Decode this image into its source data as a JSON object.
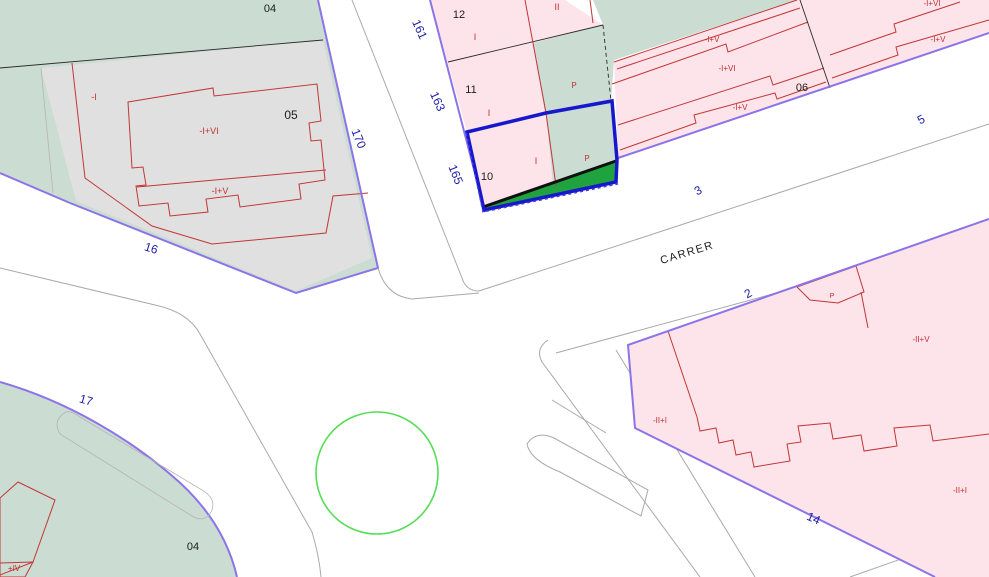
{
  "map": {
    "title": "cadastral-parcel-map",
    "street_name": "CARRER",
    "selected_parcel": {
      "number": "10",
      "zone_labels": [
        "I",
        "P"
      ]
    },
    "colors": {
      "building_fill": "#fce4ea",
      "courtyard_fill": "#cbdcd2",
      "unbuilt_fill": "#e0e0e0",
      "selection_outline": "#1717cc",
      "selection_area_fill": "#1fa33e",
      "parcel_border": "#8b74e8",
      "building_line": "#c23636",
      "street_number_text": "#1d1da8",
      "circle_stroke": "#55dd55"
    },
    "labels": [
      {
        "text": "04",
        "x": 270,
        "y": 12,
        "rot": 0,
        "cls": "lbl-black",
        "size": 11
      },
      {
        "text": "-I",
        "x": 94,
        "y": 100,
        "rot": 0,
        "cls": "lbl-red",
        "size": 9
      },
      {
        "text": "05",
        "x": 291,
        "y": 119,
        "rot": 0,
        "cls": "lbl-black",
        "size": 12
      },
      {
        "text": "-I+VI",
        "x": 209,
        "y": 134,
        "rot": 0,
        "cls": "lbl-red",
        "size": 9
      },
      {
        "text": "-I+V",
        "x": 220,
        "y": 194,
        "rot": 0,
        "cls": "lbl-red",
        "size": 9
      },
      {
        "text": "16",
        "x": 150,
        "y": 252,
        "rot": 18,
        "cls": "lbl-navy",
        "size": 12
      },
      {
        "text": "17",
        "x": 85,
        "y": 404,
        "rot": 16,
        "cls": "lbl-navy",
        "size": 12
      },
      {
        "text": "04",
        "x": 193,
        "y": 550,
        "rot": 0,
        "cls": "lbl-black",
        "size": 11
      },
      {
        "text": "+IV",
        "x": 14,
        "y": 571,
        "rot": 0,
        "cls": "lbl-red",
        "size": 8
      },
      {
        "text": "161",
        "x": 416,
        "y": 31,
        "rot": 66,
        "cls": "lbl-navy",
        "size": 12
      },
      {
        "text": "163",
        "x": 434,
        "y": 103,
        "rot": 66,
        "cls": "lbl-navy",
        "size": 12
      },
      {
        "text": "165",
        "x": 452,
        "y": 176,
        "rot": 68,
        "cls": "lbl-navy",
        "size": 12
      },
      {
        "text": "170",
        "x": 355,
        "y": 140,
        "rot": 68,
        "cls": "lbl-navy",
        "size": 12
      },
      {
        "text": "12",
        "x": 459,
        "y": 18,
        "rot": 0,
        "cls": "lbl-black",
        "size": 11
      },
      {
        "text": "I",
        "x": 475,
        "y": 40,
        "rot": 0,
        "cls": "lbl-red",
        "size": 9
      },
      {
        "text": "II",
        "x": 557,
        "y": 10,
        "rot": 0,
        "cls": "lbl-red",
        "size": 9
      },
      {
        "text": "11",
        "x": 471,
        "y": 93,
        "rot": 0,
        "cls": "lbl-black",
        "size": 11
      },
      {
        "text": "I",
        "x": 489,
        "y": 116,
        "rot": 0,
        "cls": "lbl-red",
        "size": 9
      },
      {
        "text": "P",
        "x": 574,
        "y": 88,
        "rot": 0,
        "cls": "lbl-red",
        "size": 8
      },
      {
        "text": "10",
        "x": 487,
        "y": 180,
        "rot": 0,
        "cls": "lbl-black",
        "size": 11
      },
      {
        "text": "I",
        "x": 536,
        "y": 164,
        "rot": 0,
        "cls": "lbl-red",
        "size": 9
      },
      {
        "text": "P",
        "x": 587,
        "y": 161,
        "rot": 0,
        "cls": "lbl-red",
        "size": 8
      },
      {
        "text": "-I+V",
        "x": 712,
        "y": 42,
        "rot": 0,
        "cls": "lbl-red",
        "size": 8
      },
      {
        "text": "-I+VI",
        "x": 727,
        "y": 71,
        "rot": 0,
        "cls": "lbl-red",
        "size": 8
      },
      {
        "text": "-I+V",
        "x": 740,
        "y": 110,
        "rot": 0,
        "cls": "lbl-red",
        "size": 8
      },
      {
        "text": "06",
        "x": 802,
        "y": 91,
        "rot": 0,
        "cls": "lbl-black",
        "size": 11
      },
      {
        "text": "-I+V",
        "x": 938,
        "y": 42,
        "rot": 0,
        "cls": "lbl-red",
        "size": 8
      },
      {
        "text": "-I+VI",
        "x": 932,
        "y": 6,
        "rot": 0,
        "cls": "lbl-red",
        "size": 8
      },
      {
        "text": "3",
        "x": 700,
        "y": 194,
        "rot": -28,
        "cls": "lbl-navy",
        "size": 12
      },
      {
        "text": "5",
        "x": 923,
        "y": 123,
        "rot": -28,
        "cls": "lbl-navy",
        "size": 12
      },
      {
        "text": "CARRER",
        "x": 688,
        "y": 256,
        "rot": -17,
        "cls": "lbl-street",
        "size": 11
      },
      {
        "text": "2",
        "x": 750,
        "y": 297,
        "rot": -28,
        "cls": "lbl-navy",
        "size": 12
      },
      {
        "text": "14",
        "x": 812,
        "y": 522,
        "rot": 24,
        "cls": "lbl-navy",
        "size": 12
      },
      {
        "text": "P",
        "x": 832,
        "y": 298,
        "rot": 0,
        "cls": "lbl-red",
        "size": 7
      },
      {
        "text": "-II+V",
        "x": 921,
        "y": 342,
        "rot": 0,
        "cls": "lbl-red",
        "size": 8
      },
      {
        "text": "-II+I",
        "x": 660,
        "y": 423,
        "rot": 0,
        "cls": "lbl-red",
        "size": 8
      },
      {
        "text": "-II+I",
        "x": 960,
        "y": 493,
        "rot": 0,
        "cls": "lbl-red",
        "size": 8
      }
    ]
  }
}
